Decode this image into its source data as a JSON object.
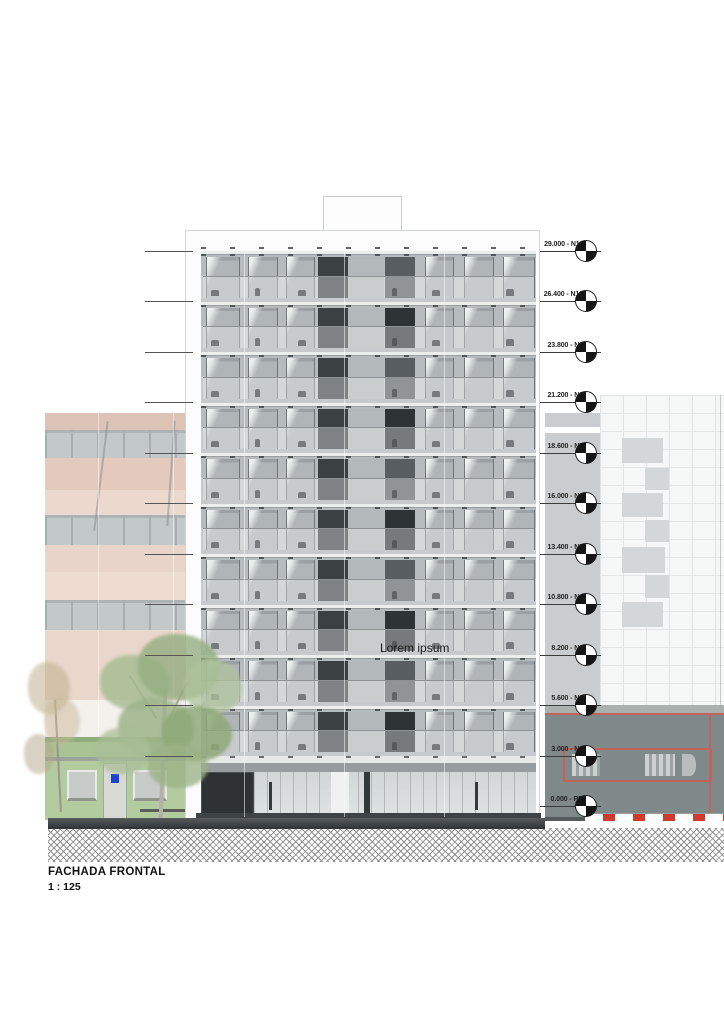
{
  "title_block": {
    "title": "FACHADA FRONTAL",
    "scale": "1 : 125"
  },
  "facade_note": "Lorem ipsum",
  "levels": [
    {
      "elevation": "29.000",
      "name": "N11"
    },
    {
      "elevation": "26.400",
      "name": "N10"
    },
    {
      "elevation": "23.800",
      "name": "N9"
    },
    {
      "elevation": "21.200",
      "name": "N8"
    },
    {
      "elevation": "18.600",
      "name": "N7"
    },
    {
      "elevation": "16.000",
      "name": "N6"
    },
    {
      "elevation": "13.400",
      "name": "N5"
    },
    {
      "elevation": "10.800",
      "name": "N4"
    },
    {
      "elevation": "8.200",
      "name": "N3"
    },
    {
      "elevation": "5.600",
      "name": "N2"
    },
    {
      "elevation": "3.000",
      "name": "N1"
    },
    {
      "elevation": "0.000",
      "name": "PB"
    }
  ],
  "building": {
    "floor_count": 10
  },
  "icons": {
    "level_marker": "level-datum-icon"
  },
  "colors": {
    "annotation_red": "#c2635a",
    "curb_red": "#cf3a2d",
    "pink_neighbor": "#e3cabd",
    "green_house": "#aac394",
    "tree_green": "#93ad7f",
    "facade_gray": "#c6cacc",
    "dark_panel": "#3b4043",
    "plaque_blue": "#1c43cf"
  }
}
